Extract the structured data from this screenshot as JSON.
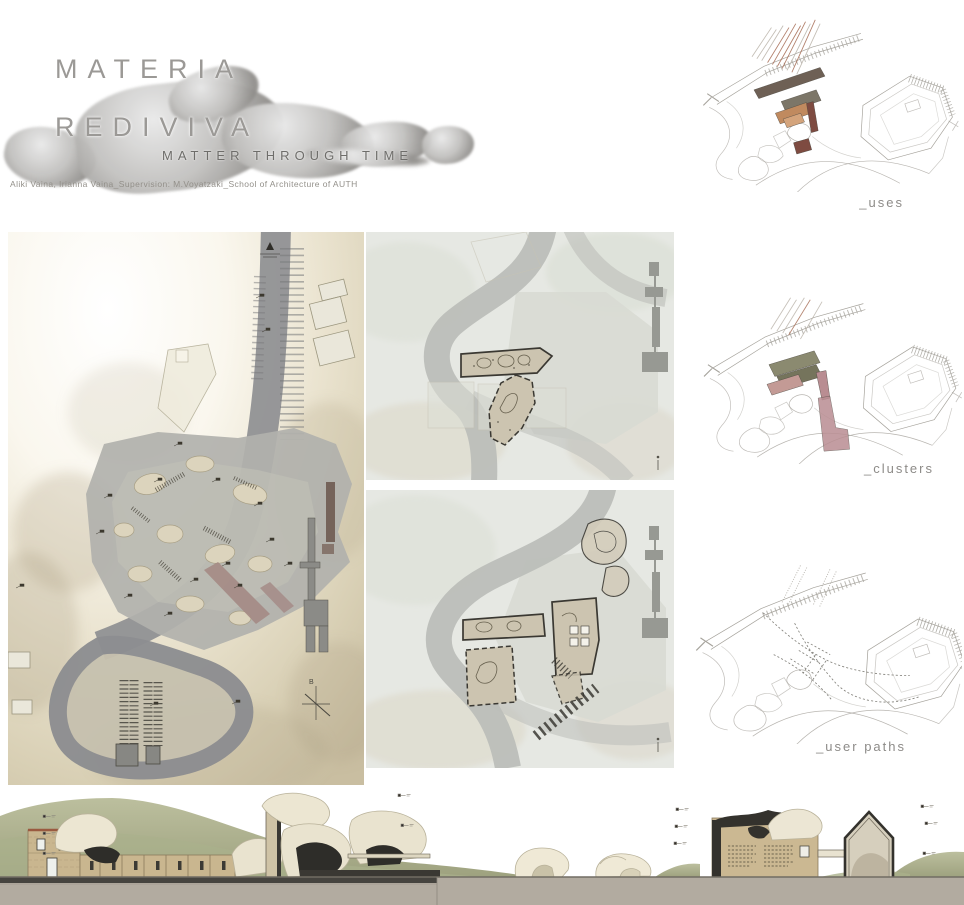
{
  "poster": {
    "title_line1": "MATERIA",
    "title_line2": "REDIVIVA",
    "subtitle": "MATTER THROUGH TIME",
    "credits": "Aliki Vaina, Irianna Vaina_Supervision: M.Voyatzaki_School of Architecture of AUTH"
  },
  "diagrams": [
    {
      "id": "uses",
      "label": "_uses"
    },
    {
      "id": "clusters",
      "label": "_clusters"
    },
    {
      "id": "user-paths",
      "label": "_user paths"
    }
  ],
  "masterplan": {
    "compass_letter": "B"
  },
  "colors": {
    "uses_brown": "#6e6055",
    "uses_olive": "#7c7668",
    "uses_orange": "#c08a5f",
    "uses_orange_light": "#d4a47c",
    "uses_red": "#7e4b41",
    "clusters_olive": "#8b8a70",
    "clusters_olive_dark": "#75745c",
    "clusters_pink": "#c39a95",
    "clusters_rose": "#b98d92",
    "plan_road": "#8c8d90",
    "plan_plateau": "#b1b1ad",
    "plan_ramp": "#a58b86",
    "section_hill": "#a9ad8c",
    "section_stone": "#c9b68f",
    "section_rock": "#ece6d2",
    "section_dark": "#34322d",
    "section_ground": "#b2aba0"
  }
}
